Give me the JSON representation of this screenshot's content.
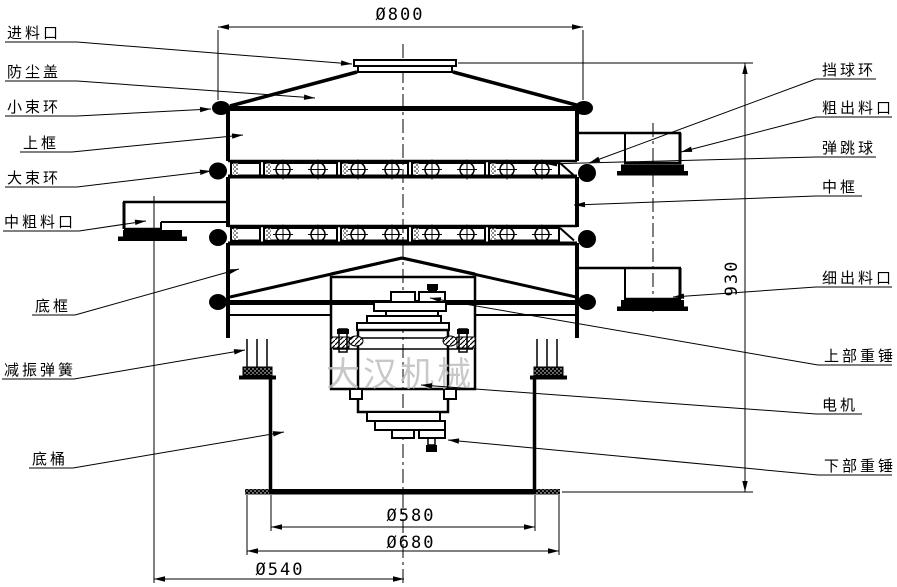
{
  "watermark": "大汉机械",
  "labels_left": [
    {
      "text": "进料口"
    },
    {
      "text": "防尘盖"
    },
    {
      "text": "小束环"
    },
    {
      "text": "上框"
    },
    {
      "text": "大束环"
    },
    {
      "text": "中粗料口"
    },
    {
      "text": "底框"
    },
    {
      "text": "减振弹簧"
    },
    {
      "text": "底桶"
    }
  ],
  "labels_right": [
    {
      "text": "挡球环"
    },
    {
      "text": "粗出料口"
    },
    {
      "text": "弹跳球"
    },
    {
      "text": "中框"
    },
    {
      "text": "细出料口"
    },
    {
      "text": "上部重锤"
    },
    {
      "text": "电机"
    },
    {
      "text": "下部重锤"
    }
  ],
  "dimensions": {
    "top_diameter": "Ø800",
    "overall_height": "930",
    "base_inner": "Ø580",
    "base_outer": "Ø680",
    "outlet_offset": "Ø540"
  }
}
